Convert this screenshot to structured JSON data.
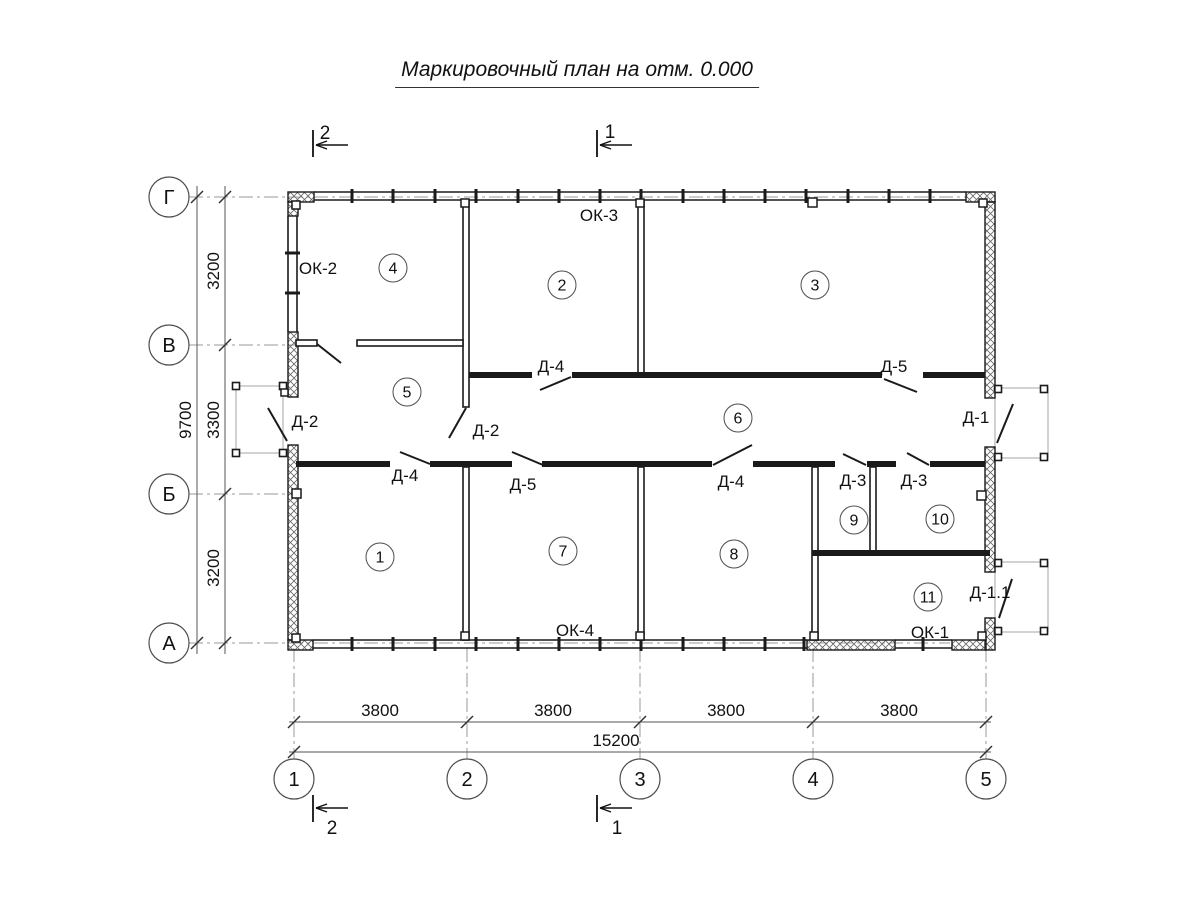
{
  "title": "Маркировочный план на отм. 0.000",
  "colors": {
    "wall": "#1a1a1a",
    "grid": "#9a9a9a",
    "dim": "#555555",
    "porch": "#b3b3b3",
    "text": "#111111",
    "hatch": "#666666",
    "bubble_stroke": "#4d4d4d"
  },
  "grid": {
    "rows": [
      {
        "label": "Г",
        "y": 197,
        "ext": 968
      },
      {
        "label": "В",
        "y": 345,
        "ext": 302
      },
      {
        "label": "Б",
        "y": 494,
        "ext": 302
      },
      {
        "label": "А",
        "y": 643,
        "ext": 950
      }
    ],
    "cols": [
      {
        "label": "1",
        "x": 294
      },
      {
        "label": "2",
        "x": 467
      },
      {
        "label": "3",
        "x": 640
      },
      {
        "label": "4",
        "x": 813
      },
      {
        "label": "5",
        "x": 986
      }
    ],
    "row_bubble_x": 169,
    "col_bubble_y": 779,
    "bubble_r": 20,
    "axis_line_x1": 189,
    "col_axis_y1": 648,
    "col_axis_y2": 759
  },
  "dims": {
    "left": {
      "seg_line_x": 225,
      "total_line_x": 197,
      "line_y1": 186,
      "line_y2": 654,
      "segments": [
        {
          "text": "3200",
          "y": 271
        },
        {
          "text": "3300",
          "y": 420
        },
        {
          "text": "3200",
          "y": 568
        }
      ],
      "total": {
        "text": "9700",
        "y": 420
      }
    },
    "bottom": {
      "seg_line_y": 722,
      "total_line_y": 752,
      "line_x1": 289,
      "line_x2": 991,
      "segments": [
        {
          "text": "3800",
          "x": 380
        },
        {
          "text": "3800",
          "x": 553
        },
        {
          "text": "3800",
          "x": 726
        },
        {
          "text": "3800",
          "x": 899
        }
      ],
      "total": {
        "text": "15200",
        "x": 616
      }
    }
  },
  "rooms": [
    {
      "n": "1",
      "x": 380,
      "y": 557
    },
    {
      "n": "2",
      "x": 562,
      "y": 285
    },
    {
      "n": "3",
      "x": 815,
      "y": 285
    },
    {
      "n": "4",
      "x": 393,
      "y": 268
    },
    {
      "n": "5",
      "x": 407,
      "y": 392
    },
    {
      "n": "6",
      "x": 738,
      "y": 418
    },
    {
      "n": "7",
      "x": 563,
      "y": 551
    },
    {
      "n": "8",
      "x": 734,
      "y": 554
    },
    {
      "n": "9",
      "x": 854,
      "y": 520
    },
    {
      "n": "10",
      "x": 940,
      "y": 519
    },
    {
      "n": "11",
      "x": 928,
      "y": 597
    }
  ],
  "door_labels": [
    {
      "text": "Д-2",
      "x": 305,
      "y": 421
    },
    {
      "text": "Д-2",
      "x": 486,
      "y": 430
    },
    {
      "text": "Д-4",
      "x": 405,
      "y": 475
    },
    {
      "text": "Д-5",
      "x": 523,
      "y": 484
    },
    {
      "text": "Д-4",
      "x": 551,
      "y": 366
    },
    {
      "text": "Д-5",
      "x": 894,
      "y": 366
    },
    {
      "text": "Д-4",
      "x": 731,
      "y": 481
    },
    {
      "text": "Д-3",
      "x": 853,
      "y": 480
    },
    {
      "text": "Д-3",
      "x": 914,
      "y": 480
    },
    {
      "text": "Д-1",
      "x": 976,
      "y": 417
    },
    {
      "text": "Д-1.1",
      "x": 990,
      "y": 592
    }
  ],
  "window_labels": [
    {
      "text": "ОК-2",
      "x": 318,
      "y": 268
    },
    {
      "text": "ОК-3",
      "x": 599,
      "y": 215
    },
    {
      "text": "ОК-4",
      "x": 575,
      "y": 630
    },
    {
      "text": "ОК-1",
      "x": 930,
      "y": 632
    }
  ],
  "section_markers": [
    {
      "num": "2",
      "nx": 325,
      "ny": 133,
      "tick": [
        313,
        130,
        313,
        157
      ],
      "arrow": [
        348,
        145,
        316,
        145
      ]
    },
    {
      "num": "1",
      "nx": 610,
      "ny": 132,
      "tick": [
        597,
        130,
        597,
        157
      ],
      "arrow": [
        632,
        145,
        600,
        145
      ]
    },
    {
      "num": "2",
      "nx": 332,
      "ny": 828,
      "tick": [
        313,
        795,
        313,
        822
      ],
      "arrow": [
        348,
        808,
        316,
        808
      ]
    },
    {
      "num": "1",
      "nx": 617,
      "ny": 828,
      "tick": [
        597,
        795,
        597,
        822
      ],
      "arrow": [
        632,
        808,
        600,
        808
      ]
    }
  ],
  "geometry": {
    "hatched_walls": [
      [
        288,
        192,
        26,
        10
      ],
      [
        288,
        202,
        10,
        14
      ],
      [
        966,
        192,
        29,
        10
      ],
      [
        985,
        202,
        10,
        196
      ],
      [
        985,
        447,
        10,
        125
      ],
      [
        985,
        618,
        10,
        32
      ],
      [
        952,
        640,
        34,
        10
      ],
      [
        807,
        640,
        88,
        10
      ],
      [
        288,
        332,
        10,
        65
      ],
      [
        288,
        445,
        10,
        195
      ],
      [
        288,
        640,
        25,
        10
      ]
    ],
    "window_bands": [
      {
        "o": "h",
        "c1": 192,
        "c2": 200,
        "a": 314,
        "b": 966,
        "ticks": [
          352,
          393,
          435,
          476,
          518,
          559,
          600,
          641,
          683,
          724,
          765,
          806,
          848,
          889,
          930
        ]
      },
      {
        "o": "h",
        "c1": 640,
        "c2": 648,
        "a": 313,
        "b": 807,
        "ticks": [
          352,
          393,
          435,
          476,
          518,
          559,
          600,
          641,
          683,
          724,
          765,
          804
        ]
      },
      {
        "o": "h",
        "c1": 640,
        "c2": 648,
        "a": 895,
        "b": 952,
        "ticks": [
          923
        ]
      },
      {
        "o": "v",
        "c1": 288,
        "c2": 297,
        "a": 216,
        "b": 332,
        "ticks": [
          253,
          293
        ]
      }
    ],
    "double_walls": [
      [
        463,
        200,
        6,
        207
      ],
      [
        638,
        200,
        6,
        175
      ],
      [
        463,
        467,
        6,
        173
      ],
      [
        638,
        467,
        6,
        173
      ],
      [
        812,
        467,
        6,
        173
      ],
      [
        870,
        467,
        6,
        86
      ],
      [
        296,
        340,
        21,
        6
      ],
      [
        357,
        340,
        106,
        6
      ]
    ],
    "solid_walls": [
      [
        469,
        372,
        63,
        6
      ],
      [
        572,
        372,
        310,
        6
      ],
      [
        923,
        372,
        62,
        6
      ],
      [
        296,
        461,
        94,
        6
      ],
      [
        430,
        461,
        82,
        6
      ],
      [
        542,
        461,
        170,
        6
      ],
      [
        753,
        461,
        82,
        6
      ],
      [
        867,
        461,
        29,
        6
      ],
      [
        930,
        461,
        55,
        6
      ],
      [
        812,
        550,
        178,
        6
      ]
    ],
    "door_leaves": [
      [
        317,
        344,
        341,
        363
      ],
      [
        268,
        408,
        287,
        441
      ],
      [
        449,
        438,
        466,
        408
      ],
      [
        540,
        390,
        571,
        377
      ],
      [
        884,
        379,
        917,
        392
      ],
      [
        400,
        452,
        430,
        464
      ],
      [
        512,
        452,
        543,
        465
      ],
      [
        713,
        465,
        752,
        445
      ],
      [
        843,
        454,
        866,
        465
      ],
      [
        907,
        453,
        929,
        465
      ],
      [
        997,
        443,
        1013,
        404
      ],
      [
        999,
        618,
        1012,
        579
      ]
    ],
    "piers": [
      [
        292,
        201,
        8,
        8
      ],
      [
        461,
        199,
        8,
        8
      ],
      [
        636,
        199,
        8,
        8
      ],
      [
        808,
        198,
        9,
        9
      ],
      [
        979,
        199,
        8,
        8
      ],
      [
        292,
        489,
        9,
        9
      ],
      [
        977,
        491,
        9,
        9
      ],
      [
        461,
        632,
        8,
        8
      ],
      [
        636,
        632,
        8,
        8
      ],
      [
        810,
        632,
        8,
        8
      ],
      [
        292,
        634,
        8,
        8
      ],
      [
        978,
        632,
        8,
        8
      ],
      [
        281,
        389,
        7,
        7
      ]
    ],
    "porches": [
      {
        "rect": [
          236,
          386,
          47,
          67
        ],
        "posts": [
          [
            236,
            386
          ],
          [
            283,
            386
          ],
          [
            236,
            453
          ],
          [
            283,
            453
          ]
        ]
      },
      {
        "rect": [
          995,
          388,
          53,
          70
        ],
        "posts": [
          [
            998,
            389
          ],
          [
            1044,
            389
          ],
          [
            998,
            457
          ],
          [
            1044,
            457
          ]
        ]
      },
      {
        "rect": [
          995,
          562,
          53,
          70
        ],
        "posts": [
          [
            998,
            563
          ],
          [
            1044,
            563
          ],
          [
            998,
            631
          ],
          [
            1044,
            631
          ]
        ]
      }
    ]
  }
}
